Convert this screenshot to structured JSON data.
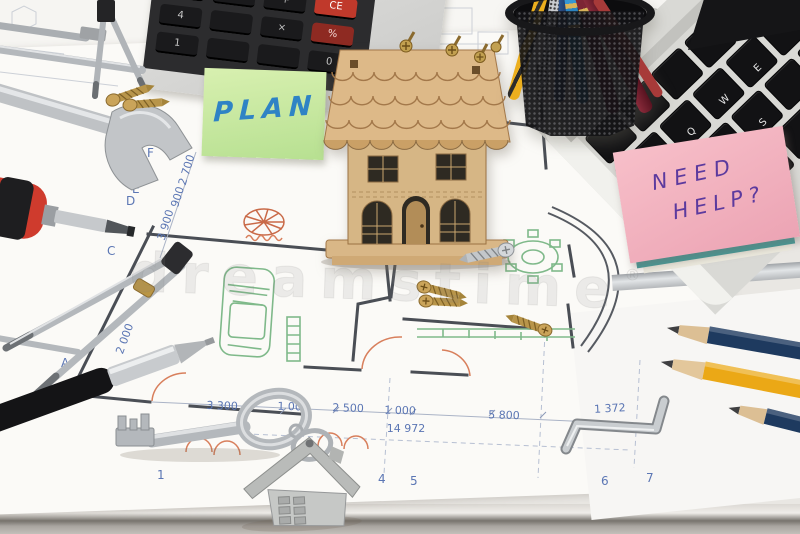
{
  "scene": {
    "description": "Architect desk: blueprints with wooden house model, tools, sticky notes, calculator, laptop",
    "watermark": {
      "text": "dreamstime",
      "reg": "®"
    }
  },
  "sticky_notes": {
    "plan": "PLAN",
    "need_help_line1": "NEED",
    "need_help_line2": "HELP?"
  },
  "calculator": {
    "key_7": "7",
    "key_4": "4",
    "key_1": "1",
    "key_0": "0",
    "key_plus": "+",
    "key_times": "×",
    "key_ce": "CE",
    "key_pct": "%"
  },
  "laptop": {
    "key_tab": "tab",
    "key_caps": "caps lock",
    "key_shift": "shift",
    "key_q": "Q",
    "key_w": "W",
    "key_e": "E",
    "key_a": "A",
    "key_s": "S",
    "key_g": "G",
    "key_z": "Z",
    "key_x": "X"
  },
  "blueprint": {
    "dims_bottom": [
      "3 300",
      "1 000",
      "2 500",
      "1 000",
      "5 800"
    ],
    "dim_total": "14 972",
    "dims_left": [
      "2 700",
      "900",
      "3 900",
      "2 000"
    ],
    "dim_right": "1 372",
    "grid_letters": [
      "F",
      "E",
      "D",
      "C",
      "A"
    ],
    "grid_numbers": [
      "1",
      "2",
      "4",
      "5",
      "6",
      "7"
    ]
  },
  "colors": {
    "note_green": "#c9e8a4",
    "note_pink": "#f2b4c0",
    "note_teal": "#3f9e9b",
    "ink_blue": "#2f83c5",
    "ink_purple": "#5c3a9e",
    "blueprint_blue": "#5b76b4",
    "plan_green": "#7fb98a",
    "plan_orange": "#d87f5c",
    "wood": "#d6b685",
    "pencil_yellow": "#eba816",
    "pencil_navy": "#1e3a5f",
    "handle_red": "#cf3b2d"
  }
}
